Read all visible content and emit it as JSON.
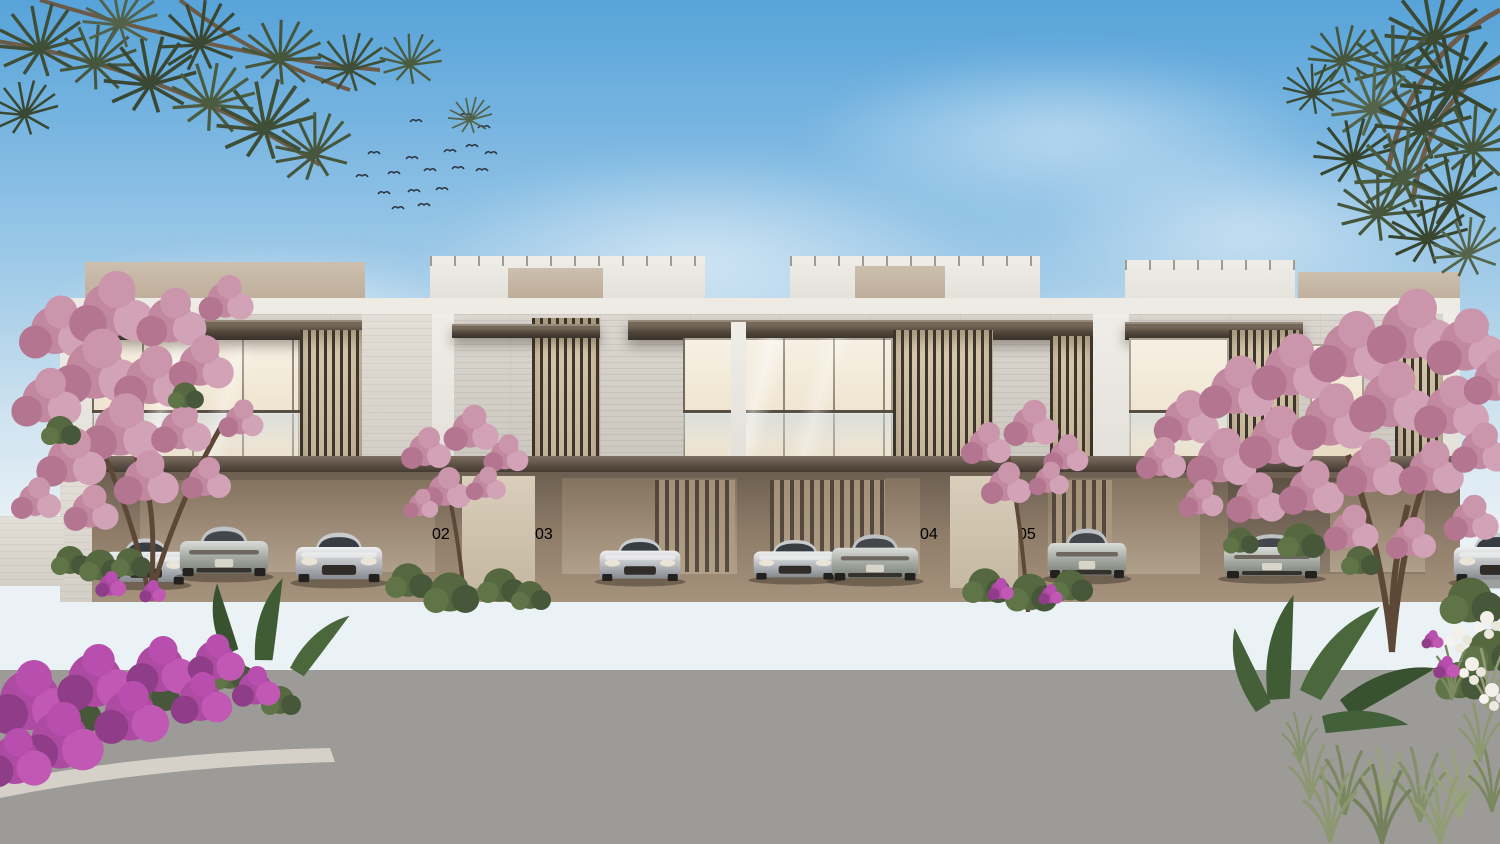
{
  "scene": {
    "type": "architectural-exterior-rendering",
    "description": "Row of modern two-storey luxury townhouses with open carports, silver luxury cars, pink flowering trees, pine branches overhead, landscaped planters, and an asphalt street with paved walkways under a blue sky with a flock of birds",
    "palette": {
      "sky_top": "#57a3d9",
      "sky_horizon": "#eaf2f6",
      "stone_cladding": "#d4d0c8",
      "white_volume": "#efede7",
      "beige_fascia": "#c6b7a5",
      "bronze_metal": "#4c433a",
      "warm_glass": "#f2ead9",
      "carport_wall": "#9b8875",
      "paver_light": "#ccbb9f",
      "paver_dark": "#b7a58a",
      "asphalt": "#9c9b98",
      "pink_blossom": "#c98ba3",
      "magenta_bougainvillea": "#b350a8",
      "foliage_green": "#51633f"
    }
  },
  "building": {
    "storeys": 2,
    "units": [
      {
        "number": "02",
        "partially_hidden": true
      },
      {
        "number": "03",
        "partially_hidden": false
      },
      {
        "number": "04",
        "partially_hidden": false
      },
      {
        "number": "05",
        "partially_hidden": true
      }
    ],
    "features": [
      "rooftop terrace parapets",
      "bronze pergola canopies",
      "glass balconies",
      "vertical bronze louver screens",
      "travertine stone cladding",
      "open carports with entry doors"
    ]
  },
  "cars": [
    {
      "bay": 1,
      "view": "front",
      "color": "silver"
    },
    {
      "bay": 1,
      "view": "rear",
      "color": "silver"
    },
    {
      "bay": 1,
      "view": "front",
      "color": "silver"
    },
    {
      "bay": 2,
      "view": "front",
      "color": "silver"
    },
    {
      "bay": 3,
      "view": "front",
      "color": "grey-green"
    },
    {
      "bay": 3,
      "view": "rear",
      "color": "silver"
    },
    {
      "bay": 4,
      "view": "rear",
      "color": "silver"
    },
    {
      "bay": 5,
      "view": "rear",
      "color": "grey-green"
    },
    {
      "bay": 6,
      "view": "front-partial",
      "color": "silver"
    }
  ],
  "environment": {
    "birds_count": 18,
    "road": {
      "surface": "asphalt",
      "marking": "white dashed centre line",
      "gutter": "dark drainage grate strips"
    },
    "plants": [
      "pine branches top-left",
      "pine tree top-right",
      "pink flowering trees",
      "bougainvillea shrub bottom-left",
      "banana-leaf plants bottom-right",
      "ornamental grasses",
      "green hedges in planters",
      "white flower spikes"
    ]
  }
}
